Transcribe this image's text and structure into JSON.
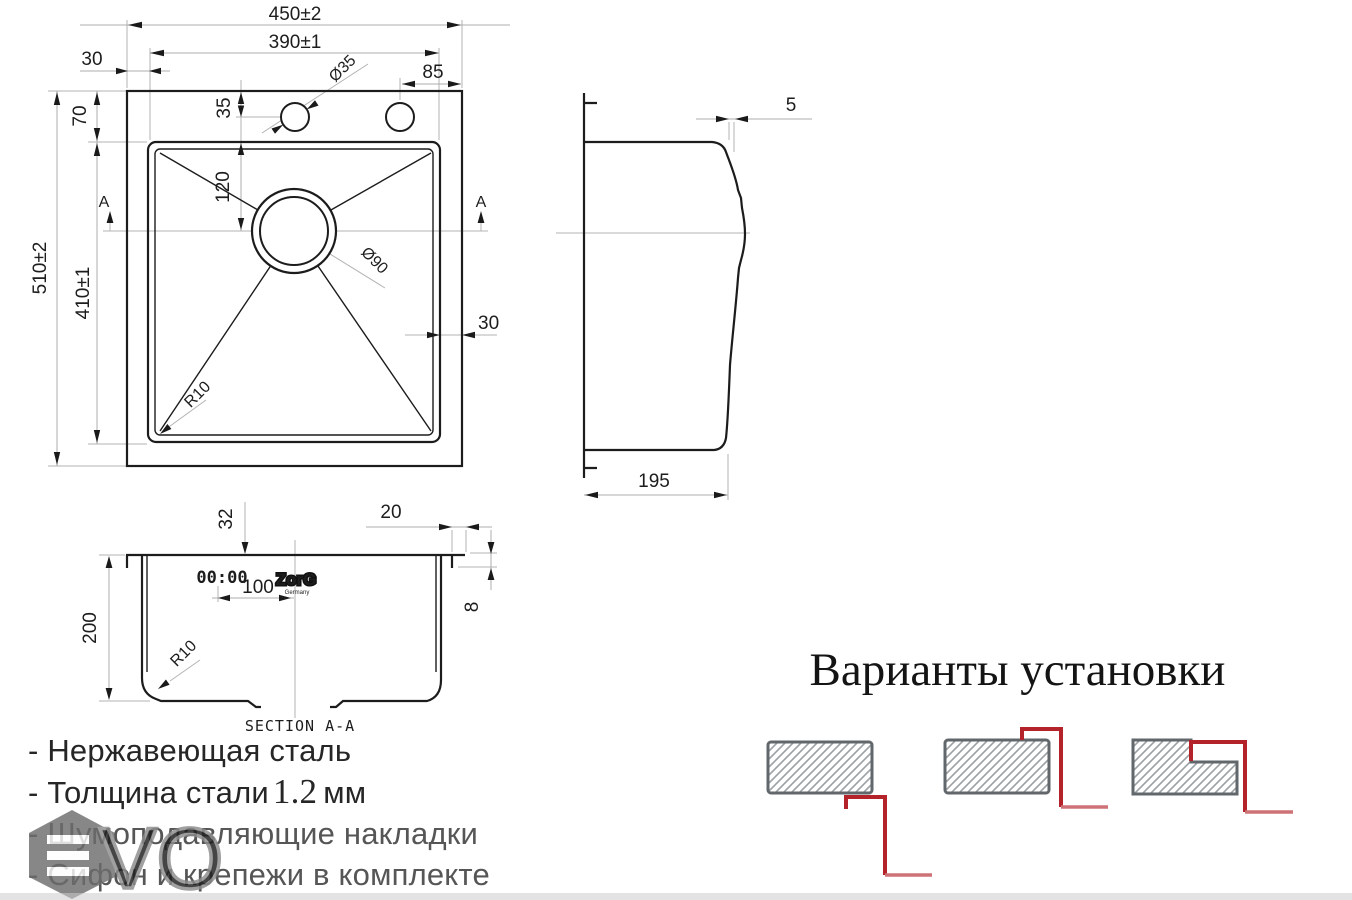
{
  "dims": {
    "w_outer": "450±2",
    "w_inner": "390±1",
    "off_left": "30",
    "hole_right": "85",
    "hole_dia": "Ø35",
    "rim_top": "70",
    "hole_top": "35",
    "drain_top": "120",
    "h_outer": "510±2",
    "h_inner": "410±1",
    "drain_dia": "Ø90",
    "rim_right": "30",
    "radius": "R10",
    "marker": "A",
    "side_lip": "5",
    "side_depth": "195",
    "sec_flange": "32",
    "sec_rim": "20",
    "sec_depth": "200",
    "sec_drain": "100",
    "sec_lip": "8",
    "sec_radius": "R10",
    "section_title": "SECTION A-A"
  },
  "brand": {
    "pads": "00:00",
    "name": "ZorG",
    "country": "Germany"
  },
  "features": {
    "line1": "- Нержавеющая сталь",
    "line2_prefix": "- Толщина стали",
    "line2_value": "1.2",
    "line2_suffix": "мм",
    "line3": "- Шумоподавляющие накладки",
    "line4": "- Сифон и крепежи в комплекте"
  },
  "installation": {
    "title": "Варианты установки"
  },
  "watermark": {
    "v": "V",
    "o": "O"
  },
  "colors": {
    "accent_red": "#b4232a",
    "accent_red_light": "#cd7276",
    "hatch_gray": "#9aa0a4",
    "line_black": "#1c1c1c"
  }
}
